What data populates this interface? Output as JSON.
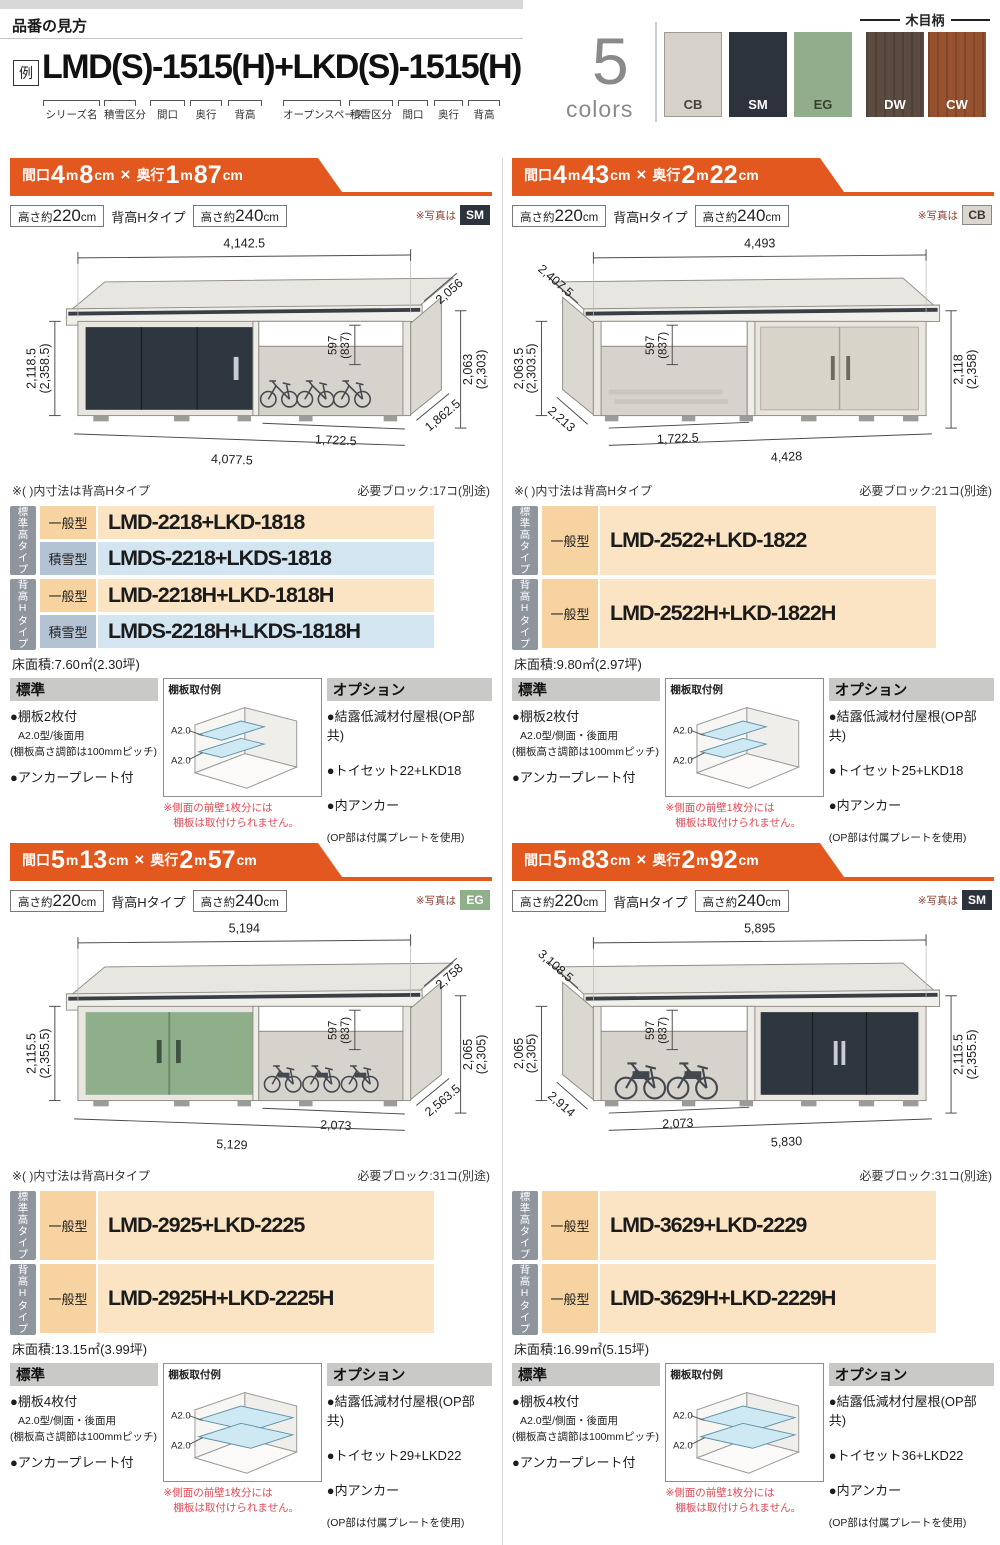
{
  "page": {
    "title": "品番の見方",
    "example_label": "例",
    "example_code": "LMD(S)-1515(H)+LKD(S)-1515(H)",
    "code_part_labels": [
      "シリーズ名",
      "積雪区分",
      "間口",
      "奥行",
      "背高",
      "オープンスペース",
      "積雪区分",
      "間口",
      "奥行",
      "背高"
    ],
    "accent_orange": "#e2581f",
    "colors": {
      "count": "5",
      "word": "colors",
      "wood_grain_label": "木目柄",
      "swatches": [
        {
          "code": "CB",
          "hex": "#d7d2c9",
          "fg": "#47433c"
        },
        {
          "code": "SM",
          "hex": "#2c333d",
          "fg": "#ffffff"
        },
        {
          "code": "EG",
          "hex": "#92ad8c",
          "fg": "#35432e"
        },
        {
          "code": "DW",
          "hex": "#5c4b41",
          "fg": "#ffffff"
        },
        {
          "code": "CW",
          "hex": "#96512e",
          "fg": "#ffffff"
        }
      ]
    }
  },
  "sections": [
    {
      "banner": {
        "label1": "間口",
        "n1": "4",
        "u1": "m",
        "n2": "8",
        "u2": "cm",
        "times": "×",
        "label2": "奥行",
        "n3": "1",
        "u3": "m",
        "n4": "87",
        "u4": "cm"
      },
      "heights": {
        "pre": "高さ約",
        "h1": "220",
        "h2": "240",
        "unit": "cm",
        "mid": "背高Hタイプ"
      },
      "photo": {
        "note": "※写真は",
        "code": "SM",
        "bg": "#2c333d",
        "fg": "#ffffff"
      },
      "shed_hex": "#2e3640",
      "diagram": {
        "top_w": "4,142.5",
        "depth_top": "2,056",
        "inner1": "597",
        "inner2": "(837)",
        "left_h1": "2,118.5",
        "left_h2": "(2,358.5)",
        "right_h1": "2,063",
        "right_h2": "(2,303)",
        "open_w": "1,722.5",
        "bot_w": "4,077.5",
        "depth_bot": "1,862.5"
      },
      "notes": {
        "inner": "※( )内寸法は背高Hタイプ",
        "blocks": "必要ブロック:17コ(別途)"
      },
      "table": {
        "groups": [
          {
            "name": "標準高タイプ",
            "rows": [
              {
                "type": "一般型",
                "code": "LMD-2218+LKD-1818"
              },
              {
                "type": "積雪型",
                "code": "LMDS-2218+LKDS-1818"
              }
            ]
          },
          {
            "name": "背高Hタイプ",
            "rows": [
              {
                "type": "一般型",
                "code": "LMD-2218H+LKD-1818H"
              },
              {
                "type": "積雪型",
                "code": "LMDS-2218H+LKDS-1818H"
              }
            ]
          }
        ]
      },
      "floor_area": "床面積:7.60㎡(2.30坪)",
      "standard": {
        "title": "標準",
        "line1": "●棚板2枚付",
        "line2": "A2.0型/後面用",
        "line3": "(棚板高さ調節は100mmピッチ)",
        "line4": "●アンカープレート付"
      },
      "shelf": {
        "title": "棚板取付例",
        "label1": "A2.0",
        "label2": "A2.0",
        "warn1": "※側面の前壁1枚分には",
        "warn2": "棚板は取付けられません。"
      },
      "options": {
        "title": "オプション",
        "item1": "●結露低減材付屋根(OP部共)",
        "item2": "●トイセット22+LKD18",
        "item3": "●内アンカー",
        "note": "(OP部は付属プレートを使用)"
      }
    },
    {
      "banner": {
        "label1": "間口",
        "n1": "4",
        "u1": "m",
        "n2": "43",
        "u2": "cm",
        "times": "×",
        "label2": "奥行",
        "n3": "2",
        "u3": "m",
        "n4": "22",
        "u4": "cm"
      },
      "heights": {
        "pre": "高さ約",
        "h1": "220",
        "h2": "240",
        "unit": "cm",
        "mid": "背高Hタイプ"
      },
      "photo": {
        "note": "※写真は",
        "code": "CB",
        "bg": "#dcd7ce",
        "fg": "#3a372f"
      },
      "shed_hex": "#d9d4ca",
      "diagram": {
        "top_w": "4,493",
        "depth_top": "2,407.5",
        "inner1": "597",
        "inner2": "(837)",
        "left_h1": "2,063.5",
        "left_h2": "(2,303.5)",
        "right_h1": "2,118",
        "right_h2": "(2,358)",
        "open_w": "1,722.5",
        "bot_w": "4,428",
        "depth_bot": "2,213"
      },
      "notes": {
        "inner": "※( )内寸法は背高Hタイプ",
        "blocks": "必要ブロック:21コ(別途)"
      },
      "table": {
        "groups": [
          {
            "name": "標準高タイプ",
            "rows": [
              {
                "type": "一般型",
                "code": "LMD-2522+LKD-1822"
              }
            ]
          },
          {
            "name": "背高Hタイプ",
            "rows": [
              {
                "type": "一般型",
                "code": "LMD-2522H+LKD-1822H"
              }
            ]
          }
        ]
      },
      "floor_area": "床面積:9.80㎡(2.97坪)",
      "standard": {
        "title": "標準",
        "line1": "●棚板2枚付",
        "line2": "A2.0型/側面・後面用",
        "line3": "(棚板高さ調節は100mmピッチ)",
        "line4": "●アンカープレート付"
      },
      "shelf": {
        "title": "棚板取付例",
        "label1": "A2.0",
        "label2": "A2.0",
        "warn1": "※側面の前壁1枚分には",
        "warn2": "棚板は取付けられません。"
      },
      "options": {
        "title": "オプション",
        "item1": "●結露低減材付屋根(OP部共)",
        "item2": "●トイセット25+LKD18",
        "item3": "●内アンカー",
        "note": "(OP部は付属プレートを使用)"
      }
    },
    {
      "banner": {
        "label1": "間口",
        "n1": "5",
        "u1": "m",
        "n2": "13",
        "u2": "cm",
        "times": "×",
        "label2": "奥行",
        "n3": "2",
        "u3": "m",
        "n4": "57",
        "u4": "cm"
      },
      "heights": {
        "pre": "高さ約",
        "h1": "220",
        "h2": "240",
        "unit": "cm",
        "mid": "背高Hタイプ"
      },
      "photo": {
        "note": "※写真は",
        "code": "EG",
        "bg": "#8fae8a",
        "fg": "#ffffff"
      },
      "shed_hex": "#8fae8a",
      "diagram": {
        "top_w": "5,194",
        "depth_top": "2,758",
        "inner1": "597",
        "inner2": "(837)",
        "left_h1": "2,115.5",
        "left_h2": "(2,355.5)",
        "right_h1": "2,065",
        "right_h2": "(2,305)",
        "open_w": "2,073",
        "bot_w": "5,129",
        "depth_bot": "2,563.5"
      },
      "notes": {
        "inner": "※( )内寸法は背高Hタイプ",
        "blocks": "必要ブロック:31コ(別途)"
      },
      "table": {
        "groups": [
          {
            "name": "標準高タイプ",
            "rows": [
              {
                "type": "一般型",
                "code": "LMD-2925+LKD-2225"
              }
            ]
          },
          {
            "name": "背高Hタイプ",
            "rows": [
              {
                "type": "一般型",
                "code": "LMD-2925H+LKD-2225H"
              }
            ]
          }
        ]
      },
      "floor_area": "床面積:13.15㎡(3.99坪)",
      "standard": {
        "title": "標準",
        "line1": "●棚板4枚付",
        "line2": "A2.0型/側面・後面用",
        "line3": "(棚板高さ調節は100mmピッチ)",
        "line4": "●アンカープレート付"
      },
      "shelf": {
        "title": "棚板取付例",
        "label1": "A2.0",
        "label2": "A2.0",
        "warn1": "※側面の前壁1枚分には",
        "warn2": "棚板は取付けられません。"
      },
      "options": {
        "title": "オプション",
        "item1": "●結露低減材付屋根(OP部共)",
        "item2": "●トイセット29+LKD22",
        "item3": "●内アンカー",
        "note": "(OP部は付属プレートを使用)"
      }
    },
    {
      "banner": {
        "label1": "間口",
        "n1": "5",
        "u1": "m",
        "n2": "83",
        "u2": "cm",
        "times": "×",
        "label2": "奥行",
        "n3": "2",
        "u3": "m",
        "n4": "92",
        "u4": "cm"
      },
      "heights": {
        "pre": "高さ約",
        "h1": "220",
        "h2": "240",
        "unit": "cm",
        "mid": "背高Hタイプ"
      },
      "photo": {
        "note": "※写真は",
        "code": "SM",
        "bg": "#2c333d",
        "fg": "#ffffff"
      },
      "shed_hex": "#2e3640",
      "diagram": {
        "top_w": "5,895",
        "depth_top": "3,108.5",
        "inner1": "597",
        "inner2": "(837)",
        "left_h1": "2,065",
        "left_h2": "(2,305)",
        "right_h1": "2,115.5",
        "right_h2": "(2,355.5)",
        "open_w": "2,073",
        "bot_w": "5,830",
        "depth_bot": "2,914"
      },
      "notes": {
        "inner": "",
        "blocks": "必要ブロック:31コ(別途)"
      },
      "table": {
        "groups": [
          {
            "name": "標準高タイプ",
            "rows": [
              {
                "type": "一般型",
                "code": "LMD-3629+LKD-2229"
              }
            ]
          },
          {
            "name": "背高Hタイプ",
            "rows": [
              {
                "type": "一般型",
                "code": "LMD-3629H+LKD-2229H"
              }
            ]
          }
        ]
      },
      "floor_area": "床面積:16.99㎡(5.15坪)",
      "standard": {
        "title": "標準",
        "line1": "●棚板4枚付",
        "line2": "A2.0型/側面・後面用",
        "line3": "(棚板高さ調節は100mmピッチ)",
        "line4": "●アンカープレート付"
      },
      "shelf": {
        "title": "棚板取付例",
        "label1": "A2.0",
        "label2": "A2.0",
        "warn1": "※側面の前壁1枚分には",
        "warn2": "棚板は取付けられません。"
      },
      "options": {
        "title": "オプション",
        "item1": "●結露低減材付屋根(OP部共)",
        "item2": "●トイセット36+LKD22",
        "item3": "●内アンカー",
        "note": "(OP部は付属プレートを使用)"
      }
    }
  ]
}
